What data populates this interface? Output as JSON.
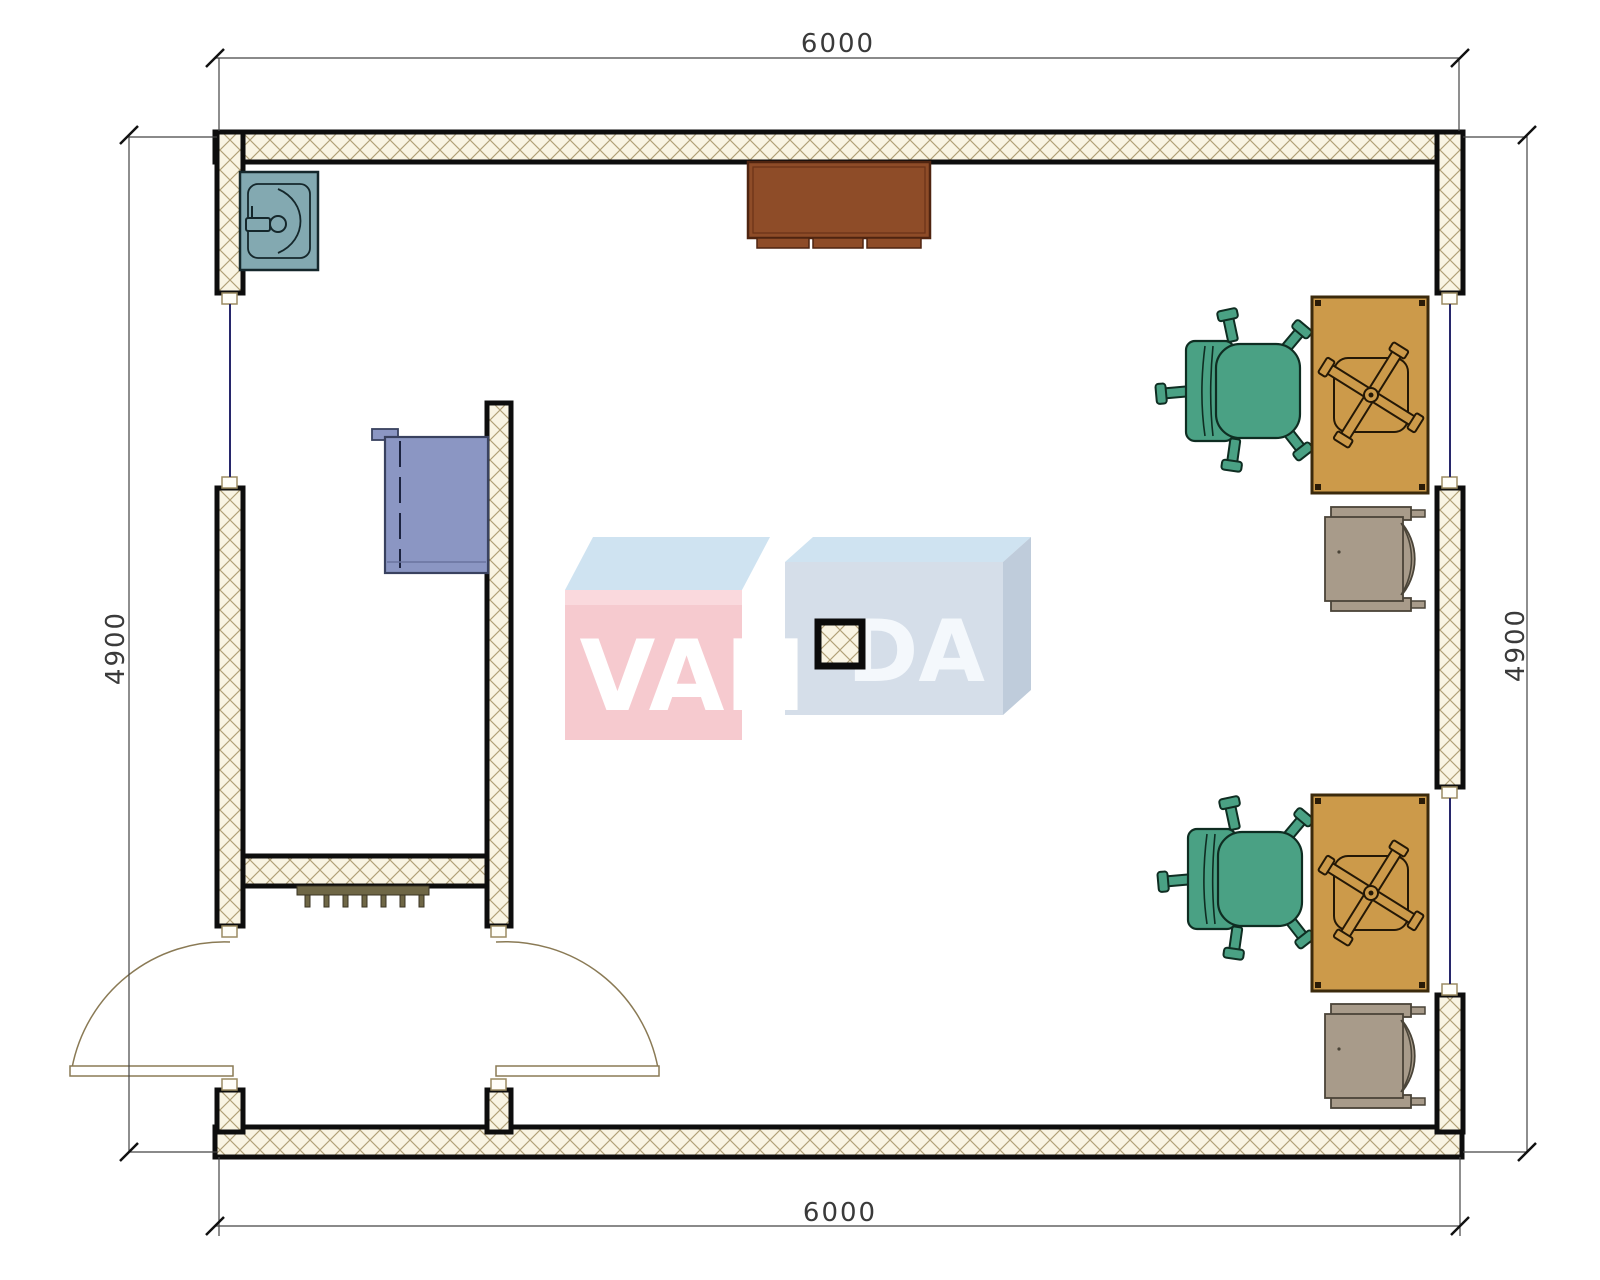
{
  "document": {
    "type": "architectural-floor-plan",
    "view": "top-down plan of a single room office/container module"
  },
  "dimensions": {
    "top": "6000",
    "bottom": "6000",
    "left": "4900",
    "right": "4900"
  },
  "watermark": {
    "left_text": "VAN",
    "right_text": "DA"
  },
  "colors": {
    "wall_outline": "#0d0d0d",
    "wall_fill": "#f9f4e3",
    "wall_hatch_line": "#b0a077",
    "window_line": "#27276b",
    "door_arc": "#8a7a55",
    "sink": "#83a9b1",
    "counter_brown": "#8e4c28",
    "cabinet_blue": "#8b96c3",
    "chair_green": "#4aa184",
    "desk_gold": "#cc9a4a",
    "armchair_taupe": "#a89b8a",
    "radiator": "#6f6746",
    "dimension_text": "#3a3a3a",
    "watermark_pink": "#f6cacf",
    "watermark_pink_band": "#fad9dd",
    "watermark_blue_top": "#cfe3f1",
    "watermark_blue_front": "#d5dee9",
    "watermark_blue_side": "#bfccdb",
    "watermark_text": "#ffffff"
  },
  "furniture": [
    {
      "name": "sink",
      "location": "top-left corner"
    },
    {
      "name": "wall-counter",
      "location": "top-center against wall"
    },
    {
      "name": "blue-cabinet",
      "location": "left interior room"
    },
    {
      "name": "radiator",
      "location": "below interior room wall"
    },
    {
      "name": "office-desk-with-swivel-base",
      "location": "right upper"
    },
    {
      "name": "green-desk-chair",
      "location": "right upper"
    },
    {
      "name": "taupe-armchair",
      "location": "right middle"
    },
    {
      "name": "office-desk-with-swivel-base",
      "location": "right lower"
    },
    {
      "name": "green-desk-chair",
      "location": "right lower"
    },
    {
      "name": "taupe-armchair",
      "location": "right bottom"
    },
    {
      "name": "structural-column",
      "location": "center"
    },
    {
      "name": "double-entry-door",
      "location": "bottom-left"
    }
  ]
}
